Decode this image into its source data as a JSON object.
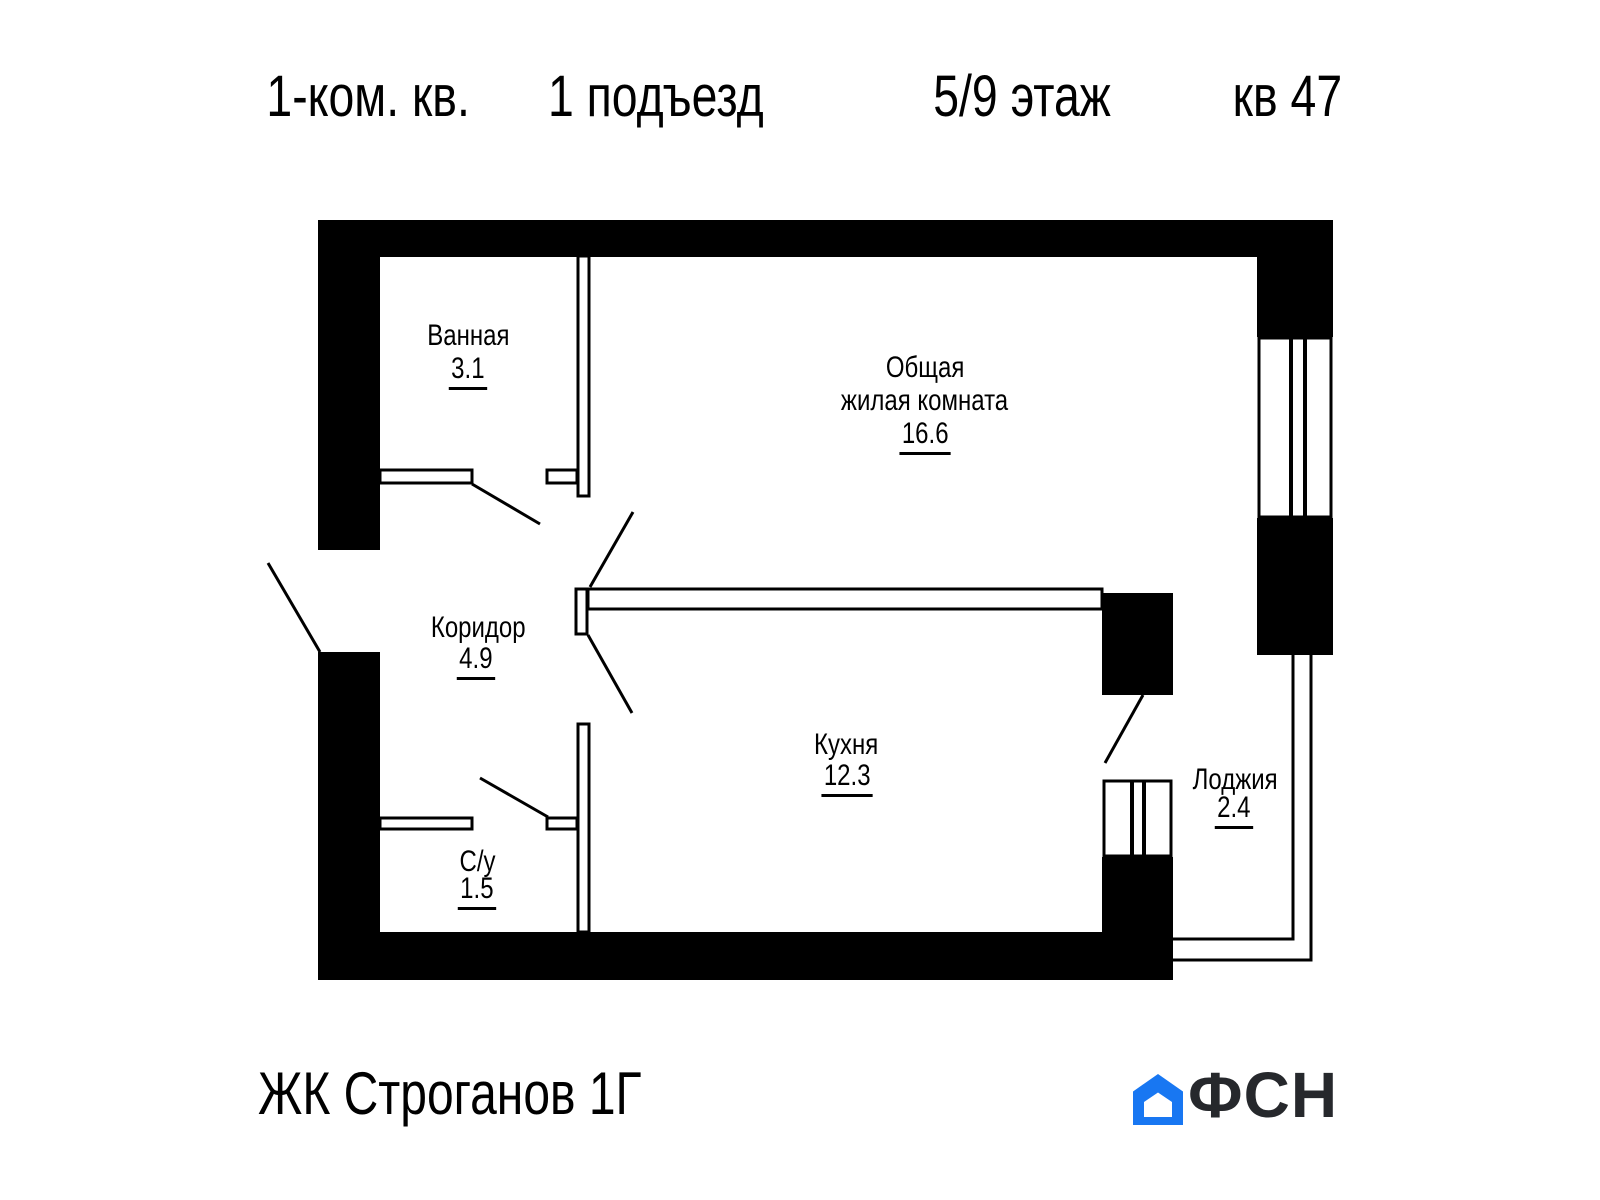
{
  "header": {
    "apartment_type": "1-ком. кв.",
    "entrance": "1 подъезд",
    "floor": "5/9 этаж",
    "apartment_number": "кв 47"
  },
  "rooms": {
    "bathroom": {
      "name": "Ванная",
      "area": "3.1"
    },
    "living": {
      "name_line1": "Общая",
      "name_line2": "жилая комната",
      "area": "16.6"
    },
    "corridor": {
      "name": "Коридор",
      "area": "4.9"
    },
    "kitchen": {
      "name": "Кухня",
      "area": "12.3"
    },
    "wc": {
      "name": "С/у",
      "area": "1.5"
    },
    "loggia": {
      "name": "Лоджия",
      "area": "2.4"
    }
  },
  "footer": {
    "complex_name": "ЖК Строганов 1Г",
    "logo_text": "ФСН"
  },
  "colors": {
    "logo_blue": "#1877F2",
    "logo_text_color": "#26282c",
    "wall_color": "#000000"
  }
}
